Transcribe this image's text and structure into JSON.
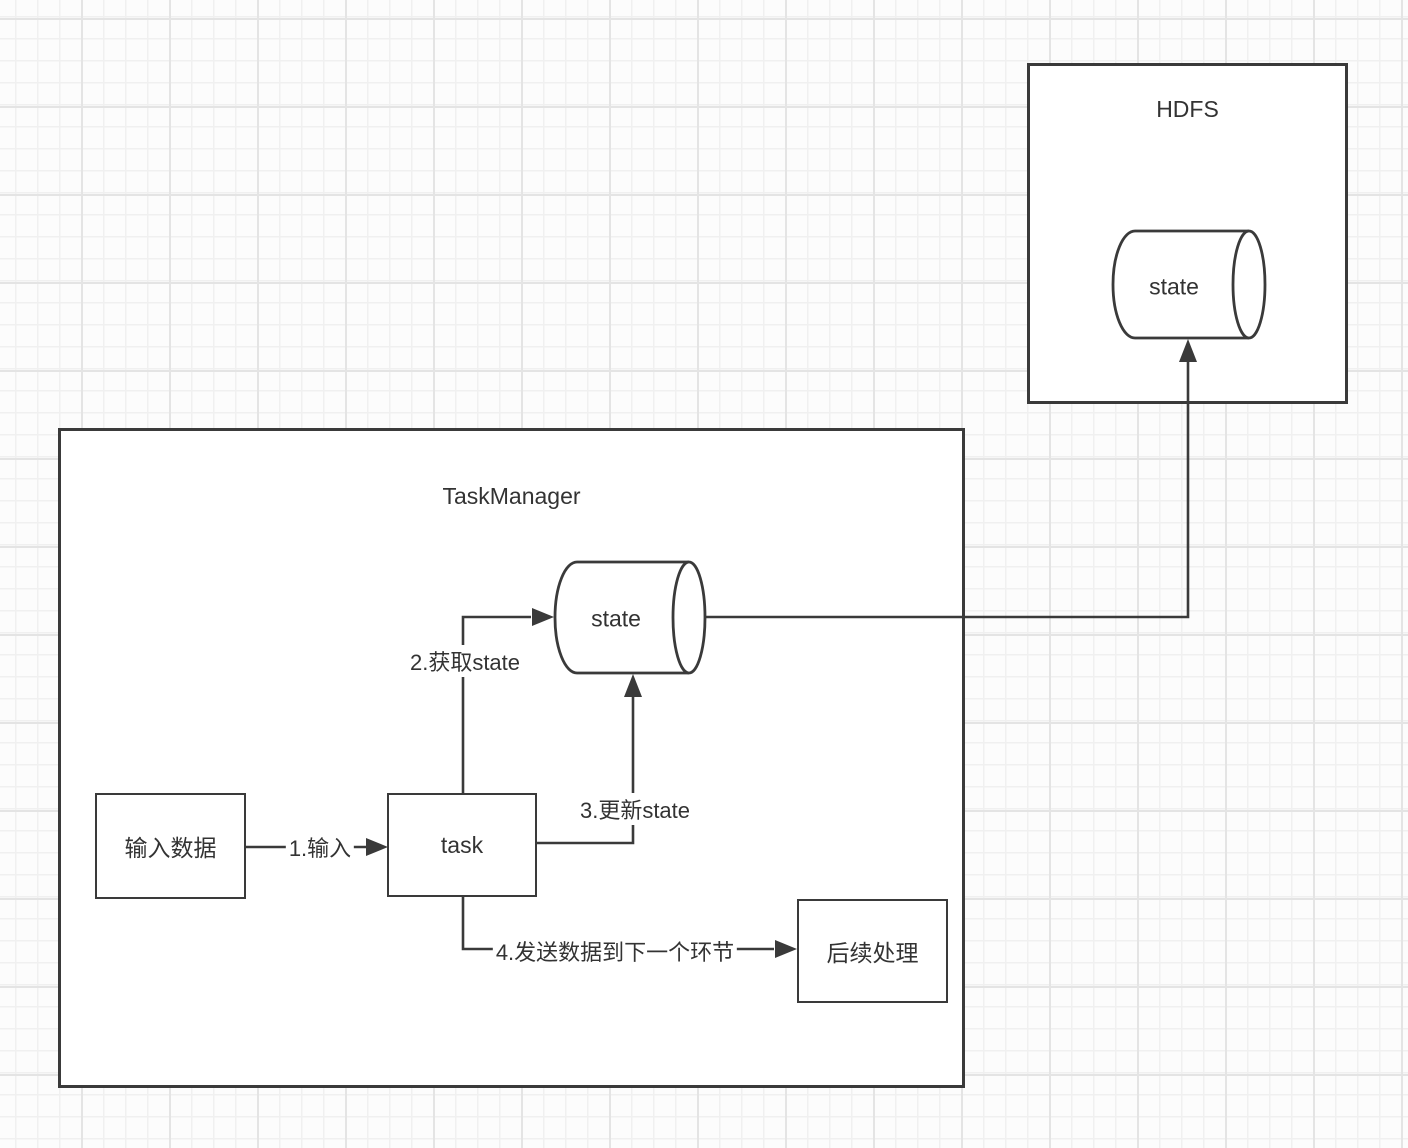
{
  "canvas": {
    "hdfs": {
      "title": "HDFS",
      "state_label": "state"
    },
    "task_manager": {
      "title": "TaskManager"
    },
    "nodes": {
      "input": "输入数据",
      "task": "task",
      "tm_state": "state",
      "followup": "后续处理"
    },
    "edges": {
      "input_edge": "1.输入",
      "get_state": "2.获取state",
      "update_state": "3.更新state",
      "send_next": "4.发送数据到下一个环节"
    },
    "colors": {
      "stroke": "#3a3a3a",
      "text": "#333333",
      "shape_fill": "#ffffff",
      "grid_minor": "#f0f0f0",
      "grid_major": "#e4e4e4",
      "background": "#fcfcfc"
    }
  }
}
